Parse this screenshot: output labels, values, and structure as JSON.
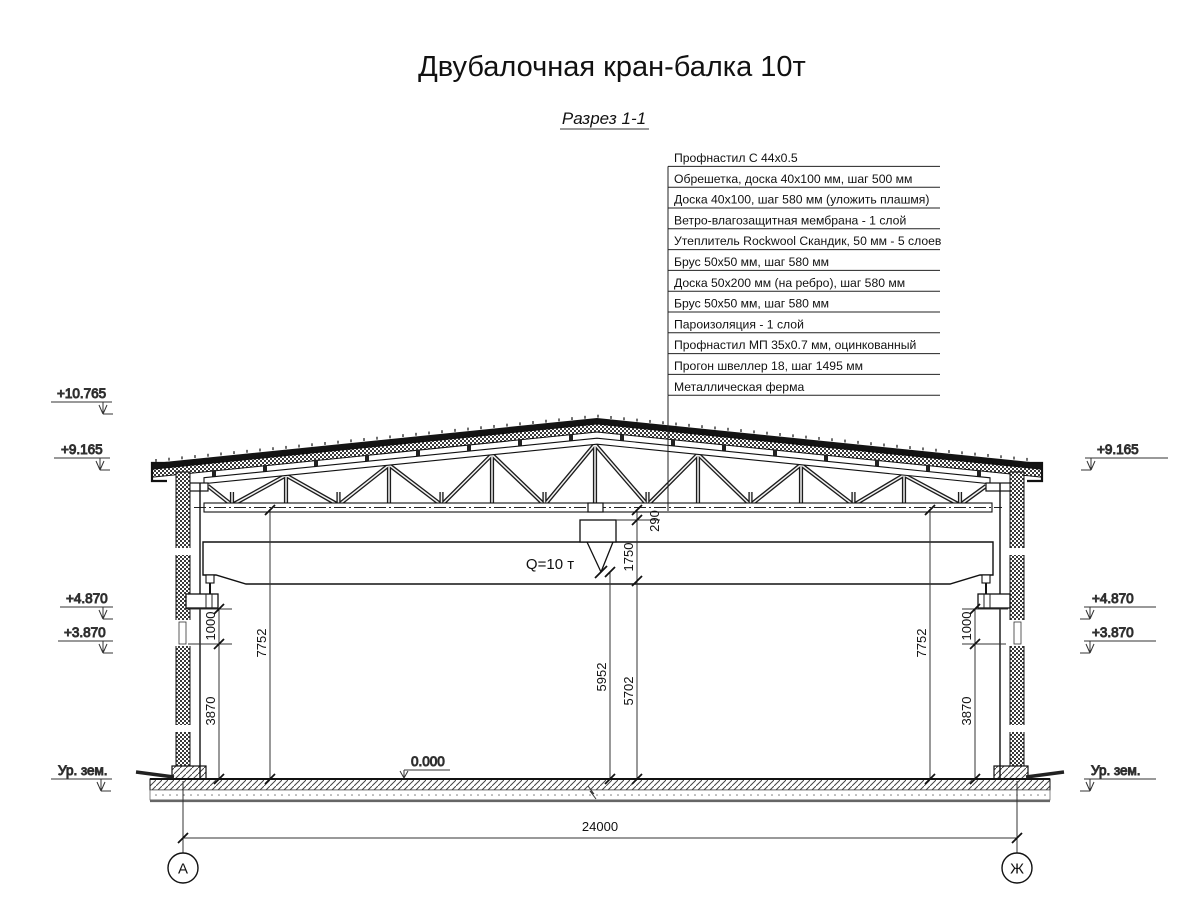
{
  "title": "Двубалочная кран-балка 10т",
  "subtitle": "Разрез 1-1",
  "callout_table": {
    "rows": [
      "Профнастил С 44х0.5",
      "Обрешетка, доска 40х100 мм, шаг 500 мм",
      "Доска 40х100, шаг 580 мм (уложить плашмя)",
      "Ветро-влагозащитная мембрана - 1 слой",
      "Утеплитель Rockwool Скандик, 50 мм - 5 слоев",
      "Брус 50х50 мм, шаг 580 мм",
      "Доска 50х200 мм (на ребро), шаг 580 мм",
      "Брус 50х50 мм, шаг 580 мм",
      "Пароизоляция - 1 слой",
      "Профнастил МП 35х0.7 мм, оцинкованный",
      "Прогон швеллер 18, шаг 1495 мм",
      "Металлическая ферма"
    ]
  },
  "elevations": {
    "left": {
      "ridge": "+10.765",
      "eaves": "+9.165",
      "rail": "+4.870",
      "corbel": "+3.870",
      "ground": "Ур. зем."
    },
    "right": {
      "eaves": "+9.165",
      "rail": "+4.870",
      "corbel": "+3.870",
      "ground": "Ур. зем."
    },
    "floor": "0.000"
  },
  "dimensions": {
    "span": "24000",
    "truss_clear": "7752",
    "hook_clear": "5952",
    "girder_clear": "5702",
    "crane_height": "1750",
    "rail_gap": "290",
    "corbel_height": "1000",
    "below_corbel": "3870"
  },
  "crane": {
    "capacity_label": "Q=10 т"
  },
  "axes": {
    "left": "А",
    "right": "Ж"
  }
}
